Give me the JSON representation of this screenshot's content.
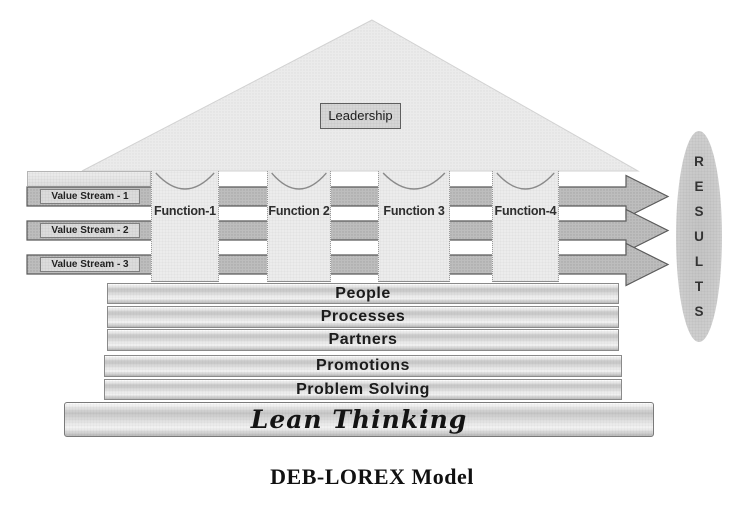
{
  "diagram": {
    "caption": "DEB-LOREX Model",
    "leadership": {
      "label": "Leadership"
    },
    "functions": [
      {
        "label": "Function-1"
      },
      {
        "label": "Function 2"
      },
      {
        "label": "Function 3"
      },
      {
        "label": "Function-4"
      }
    ],
    "value_streams": [
      {
        "label": "Value Stream - 1"
      },
      {
        "label": "Value Stream - 2"
      },
      {
        "label": "Value Stream - 3"
      }
    ],
    "foundation_layers": [
      {
        "label": "People"
      },
      {
        "label": "Processes"
      },
      {
        "label": "Partners"
      },
      {
        "label": "Promotions"
      },
      {
        "label": "Problem Solving"
      }
    ],
    "base": {
      "label": "Lean Thinking"
    },
    "results": {
      "word": "RESULTS",
      "letters": [
        "R",
        "E",
        "S",
        "U",
        "L",
        "T",
        "S"
      ]
    },
    "colors": {
      "roof_fill": "#ebebeb",
      "column_fill": "#ececec",
      "arrow_fill": "#bdbdbd",
      "label_box_fill": "#dcdcdc",
      "leadership_fill": "#d6d6d6",
      "results_oval_fill": "#c9c9c9",
      "text": "#1b1b1b"
    }
  }
}
